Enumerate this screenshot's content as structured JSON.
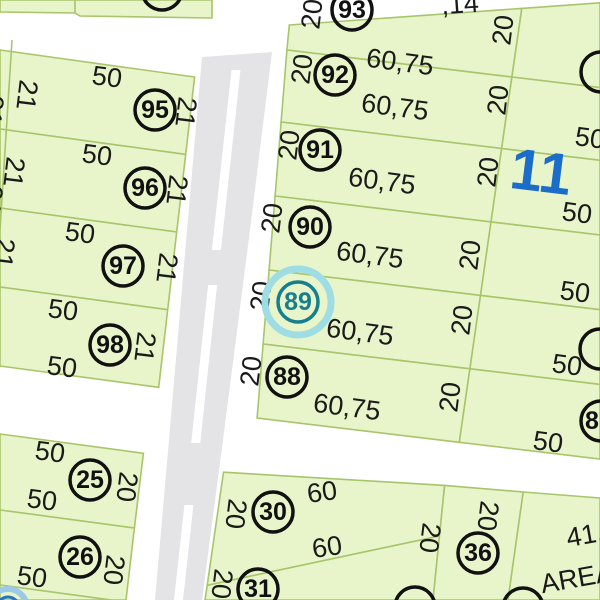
{
  "map": {
    "width": 600,
    "height": 600,
    "colors": {
      "parcel_fill": "#e8f4ca",
      "boundary": "#a8c56b",
      "road": "#ffffff",
      "pavement": "#e4e4e6",
      "label": "#1a1a1a",
      "circle_stroke": "#111111",
      "block_label_blue": "#1c6cc9",
      "highlight_teal": "#157f8d",
      "highlight_halo": "#9fdde4",
      "secondary_blue": "#2a74ba",
      "secondary_halo": "#9cc9e8"
    },
    "block_number": {
      "text": "11",
      "x": 541,
      "y": 172,
      "rot": 7,
      "size": 58
    },
    "parcels": [
      {
        "id": "north-strip",
        "pts": [
          [
            0,
            0
          ],
          [
            212,
            0
          ],
          [
            212,
            18
          ],
          [
            80,
            16
          ],
          [
            75,
            13
          ],
          [
            0,
            12
          ]
        ]
      },
      {
        "id": "95",
        "pts": [
          [
            0,
            50
          ],
          [
            194.6,
            77
          ],
          [
            185.7,
            154.4
          ],
          [
            0,
            129
          ]
        ]
      },
      {
        "id": "96",
        "pts": [
          [
            0,
            129
          ],
          [
            185.7,
            154.4
          ],
          [
            176.7,
            232
          ],
          [
            0,
            208
          ]
        ]
      },
      {
        "id": "97",
        "pts": [
          [
            0,
            208
          ],
          [
            176.7,
            232
          ],
          [
            167.7,
            309.7
          ],
          [
            0,
            287
          ]
        ]
      },
      {
        "id": "98",
        "pts": [
          [
            0,
            287
          ],
          [
            167.7,
            309.7
          ],
          [
            158.7,
            387.3
          ],
          [
            0,
            366
          ]
        ]
      },
      {
        "id": "25",
        "pts": [
          [
            0,
            434
          ],
          [
            143.4,
            453.3
          ],
          [
            134.4,
            528
          ],
          [
            0,
            510
          ]
        ]
      },
      {
        "id": "26",
        "pts": [
          [
            0,
            510
          ],
          [
            134.4,
            528
          ],
          [
            126,
            600
          ],
          [
            111,
            600
          ],
          [
            0,
            585
          ]
        ]
      },
      {
        "id": "sw-sliver",
        "pts": [
          [
            0,
            585
          ],
          [
            111,
            600
          ],
          [
            0,
            600
          ]
        ]
      },
      {
        "id": "93",
        "pts": [
          [
            289.3,
            25
          ],
          [
            521.8,
            8.4
          ],
          [
            511.9,
            77
          ],
          [
            286.9,
            50
          ]
        ]
      },
      {
        "id": "92",
        "pts": [
          [
            286.9,
            50
          ],
          [
            511.9,
            77
          ],
          [
            501.6,
            148.5
          ],
          [
            281.1,
            122
          ]
        ]
      },
      {
        "id": "91",
        "pts": [
          [
            281.1,
            122
          ],
          [
            501.6,
            148.5
          ],
          [
            491,
            221.9
          ],
          [
            275.1,
            196
          ]
        ]
      },
      {
        "id": "90",
        "pts": [
          [
            275.1,
            196
          ],
          [
            491,
            221.9
          ],
          [
            480.5,
            295.4
          ],
          [
            269.1,
            270
          ]
        ]
      },
      {
        "id": "89",
        "pts": [
          [
            269.1,
            270
          ],
          [
            480.5,
            295.4
          ],
          [
            469.9,
            368.8
          ],
          [
            263.1,
            344
          ]
        ]
      },
      {
        "id": "88",
        "pts": [
          [
            263.1,
            344
          ],
          [
            469.9,
            368.8
          ],
          [
            459.3,
            442.3
          ],
          [
            257.1,
            418
          ]
        ]
      },
      {
        "id": "east-93",
        "pts": [
          [
            521.8,
            8.4
          ],
          [
            600,
            2.8
          ],
          [
            600,
            87.6
          ],
          [
            511.9,
            77
          ]
        ]
      },
      {
        "id": "east-92",
        "pts": [
          [
            511.9,
            77
          ],
          [
            600,
            87.6
          ],
          [
            600,
            160.3
          ],
          [
            501.6,
            148.5
          ]
        ]
      },
      {
        "id": "east-91",
        "pts": [
          [
            501.6,
            148.5
          ],
          [
            600,
            160.3
          ],
          [
            600,
            235
          ],
          [
            491,
            221.9
          ]
        ]
      },
      {
        "id": "east-90",
        "pts": [
          [
            491,
            221.9
          ],
          [
            600,
            235
          ],
          [
            600,
            309.7
          ],
          [
            480.5,
            295.4
          ]
        ]
      },
      {
        "id": "east-89",
        "pts": [
          [
            480.5,
            295.4
          ],
          [
            600,
            309.7
          ],
          [
            600,
            384.4
          ],
          [
            469.9,
            368.8
          ]
        ]
      },
      {
        "id": "east-88",
        "pts": [
          [
            469.9,
            368.8
          ],
          [
            600,
            384.4
          ],
          [
            600,
            459.1
          ],
          [
            459.3,
            442.3
          ]
        ]
      },
      {
        "id": "30",
        "pts": [
          [
            223.5,
            472.2
          ],
          [
            444.6,
            485.4
          ],
          [
            439.5,
            536
          ],
          [
            207.2,
            585.4
          ]
        ]
      },
      {
        "id": "31",
        "pts": [
          [
            207.2,
            585.4
          ],
          [
            439.5,
            536
          ],
          [
            433,
            600
          ],
          [
            205,
            600
          ]
        ]
      },
      {
        "id": "36",
        "pts": [
          [
            444.6,
            485.4
          ],
          [
            523.2,
            492
          ],
          [
            508,
            600
          ],
          [
            433,
            600
          ]
        ]
      },
      {
        "id": "area-lot",
        "pts": [
          [
            523.2,
            492
          ],
          [
            600,
            498
          ],
          [
            600,
            600
          ],
          [
            508,
            600
          ]
        ]
      }
    ],
    "extra_lines": [
      [
        [
          12,
          40
        ],
        [
          0,
          230
        ]
      ],
      [
        [
          75,
          0
        ],
        [
          75,
          13
        ]
      ],
      [
        [
          147,
          0
        ],
        [
          147,
          4
        ]
      ]
    ],
    "pavement": [
      [
        202,
        57
      ],
      [
        272,
        52
      ],
      [
        250,
        230
      ],
      [
        223,
        440
      ],
      [
        202,
        600
      ],
      [
        155,
        600
      ],
      [
        169,
        440
      ],
      [
        187,
        230
      ]
    ],
    "dashes": [
      [
        [
          231.5,
          70
        ],
        [
          240.5,
          70
        ],
        [
          220.9,
          250
        ],
        [
          211.9,
          250
        ]
      ],
      [
        [
          208.1,
          285
        ],
        [
          217.1,
          285
        ],
        [
          200.2,
          443
        ],
        [
          191.2,
          443
        ]
      ],
      [
        [
          184.4,
          505
        ],
        [
          193.4,
          505
        ],
        [
          183,
          600
        ],
        [
          174,
          600
        ]
      ]
    ],
    "dimension_labels": [
      {
        "t": ",14",
        "x": 460,
        "y": 4,
        "r": -4
      },
      {
        "t": "50",
        "x": 107,
        "y": 77,
        "r": 7.5
      },
      {
        "t": "50",
        "x": 97,
        "y": 155,
        "r": 7.5
      },
      {
        "t": "50",
        "x": 80,
        "y": 233,
        "r": 7.5
      },
      {
        "t": "50",
        "x": 63,
        "y": 310,
        "r": 7.5
      },
      {
        "t": "50",
        "x": 62,
        "y": 367,
        "r": 7.5
      },
      {
        "t": "50",
        "x": 50,
        "y": 452,
        "r": 7.5
      },
      {
        "t": "50",
        "x": 42,
        "y": 500,
        "r": 7.5
      },
      {
        "t": "50",
        "x": 32,
        "y": 577,
        "r": 7.5
      },
      {
        "t": "21",
        "x": 27,
        "y": 95,
        "r": 97
      },
      {
        "t": "21",
        "x": -7,
        "y": 110,
        "r": 97
      },
      {
        "t": "21",
        "x": 186,
        "y": 112,
        "r": 97
      },
      {
        "t": "21",
        "x": 14,
        "y": 172,
        "r": 97
      },
      {
        "t": "21",
        "x": -8,
        "y": 200,
        "r": 97
      },
      {
        "t": "21",
        "x": 177,
        "y": 190,
        "r": 97
      },
      {
        "t": "21",
        "x": 4,
        "y": 253,
        "r": 97
      },
      {
        "t": "21",
        "x": 167,
        "y": 268,
        "r": 97
      },
      {
        "t": "21",
        "x": 145,
        "y": 347,
        "r": 97
      },
      {
        "t": "20",
        "x": 127,
        "y": 487,
        "r": 97
      },
      {
        "t": "20",
        "x": 114,
        "y": 570,
        "r": 97
      },
      {
        "t": "60,75",
        "x": 400,
        "y": 62,
        "r": 7.5
      },
      {
        "t": "60,75",
        "x": 395,
        "y": 107,
        "r": 7.5
      },
      {
        "t": "60,75",
        "x": 382,
        "y": 181,
        "r": 7.5
      },
      {
        "t": "60,75",
        "x": 370,
        "y": 255,
        "r": 7.5
      },
      {
        "t": "60,75",
        "x": 360,
        "y": 332,
        "r": 7.5
      },
      {
        "t": "60,75",
        "x": 347,
        "y": 407,
        "r": 7.5
      },
      {
        "t": "20",
        "x": 312,
        "y": 14,
        "r": -83
      },
      {
        "t": "20",
        "x": 302,
        "y": 69,
        "r": -83
      },
      {
        "t": "20",
        "x": 289,
        "y": 145,
        "r": -83
      },
      {
        "t": "20",
        "x": 272,
        "y": 218,
        "r": -83
      },
      {
        "t": "20",
        "x": 261,
        "y": 296,
        "r": -83
      },
      {
        "t": "20",
        "x": 251,
        "y": 371,
        "r": -83
      },
      {
        "t": "20",
        "x": 503,
        "y": 30,
        "r": -83
      },
      {
        "t": "20",
        "x": 498,
        "y": 100,
        "r": -83
      },
      {
        "t": "20",
        "x": 488,
        "y": 172,
        "r": -83
      },
      {
        "t": "20",
        "x": 470,
        "y": 255,
        "r": -83
      },
      {
        "t": "20",
        "x": 462,
        "y": 320,
        "r": -83
      },
      {
        "t": "20",
        "x": 450,
        "y": 397,
        "r": -83
      },
      {
        "t": "50",
        "x": 590,
        "y": 138,
        "r": 7.5
      },
      {
        "t": "50",
        "x": 577,
        "y": 213,
        "r": 7.5
      },
      {
        "t": "50",
        "x": 575,
        "y": 292,
        "r": 7.5
      },
      {
        "t": "50",
        "x": 567,
        "y": 365,
        "r": 7.5
      },
      {
        "t": "50",
        "x": 548,
        "y": 442,
        "r": 7.5
      },
      {
        "t": "60",
        "x": 322,
        "y": 492,
        "r": -8
      },
      {
        "t": "60",
        "x": 327,
        "y": 547,
        "r": -8
      },
      {
        "t": "20",
        "x": 236,
        "y": 514,
        "r": 97
      },
      {
        "t": "20",
        "x": 430,
        "y": 538,
        "r": 97
      },
      {
        "t": "20",
        "x": 222,
        "y": 584,
        "r": 97
      },
      {
        "t": "20",
        "x": 488,
        "y": 516,
        "r": 97
      },
      {
        "t": "41,",
        "x": 585,
        "y": 535,
        "r": -10
      },
      {
        "t": "AREA",
        "x": 577,
        "y": 578,
        "r": -10
      }
    ],
    "circled_numbers": [
      {
        "n": "95",
        "x": 155,
        "y": 110,
        "style": "normal"
      },
      {
        "n": "96",
        "x": 145,
        "y": 188,
        "style": "normal"
      },
      {
        "n": "97",
        "x": 123,
        "y": 266,
        "style": "normal"
      },
      {
        "n": "98",
        "x": 110,
        "y": 345,
        "style": "normal"
      },
      {
        "n": "25",
        "x": 90,
        "y": 480,
        "style": "normal"
      },
      {
        "n": "26",
        "x": 80,
        "y": 557,
        "style": "normal"
      },
      {
        "n": "93",
        "x": 352,
        "y": 10,
        "style": "normal"
      },
      {
        "n": "92",
        "x": 335,
        "y": 75,
        "style": "normal"
      },
      {
        "n": "91",
        "x": 320,
        "y": 150,
        "style": "normal"
      },
      {
        "n": "90",
        "x": 310,
        "y": 227,
        "style": "normal"
      },
      {
        "n": "88",
        "x": 287,
        "y": 377,
        "style": "normal"
      },
      {
        "n": "30",
        "x": 273,
        "y": 512,
        "style": "normal"
      },
      {
        "n": "31",
        "x": 258,
        "y": 589,
        "style": "normal"
      },
      {
        "n": "36",
        "x": 478,
        "y": 553,
        "style": "normal"
      },
      {
        "n": "8",
        "x": 601,
        "y": 421,
        "tdx": -9,
        "style": "normal"
      },
      {
        "n": "",
        "x": 601,
        "y": 72,
        "style": "normal"
      },
      {
        "n": "",
        "x": 600,
        "y": 349,
        "style": "normal"
      },
      {
        "n": "",
        "x": 162,
        "y": -10,
        "style": "normal"
      },
      {
        "n": "",
        "x": 415,
        "y": 607,
        "style": "normal"
      },
      {
        "n": "",
        "x": 523,
        "y": 608,
        "style": "normal"
      },
      {
        "n": "89",
        "x": 298,
        "y": 302,
        "style": "highlight"
      },
      {
        "n": "",
        "x": 8,
        "y": 608,
        "style": "blue"
      }
    ]
  }
}
